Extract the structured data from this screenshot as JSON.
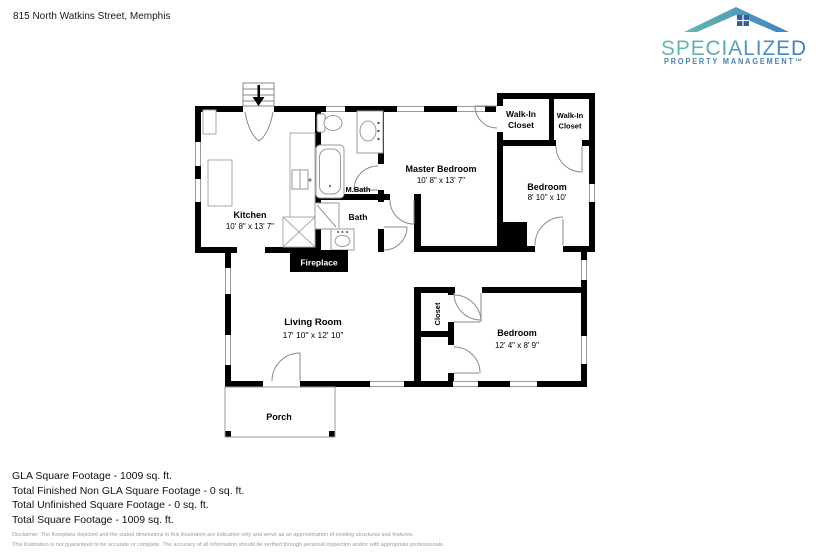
{
  "header": {
    "address": "815 North Watkins Street, Memphis"
  },
  "logo": {
    "brand": "SPECIALIZED",
    "tagline": "PROPERTY MANAGEMENT™",
    "gradient_start": "#63b7ac",
    "gradient_mid": "#4e97bd",
    "gradient_end": "#3e7ec4",
    "tagline_color": "#4c80ad",
    "roof_window_color": "#2d5f96"
  },
  "floorplan": {
    "wall_color": "#000000",
    "fixture_color": "#999999",
    "kitchen": {
      "name": "Kitchen",
      "dims": "10' 8\" x 13' 7\""
    },
    "master_bath": {
      "name": "M.Bath"
    },
    "bath": {
      "name": "Bath"
    },
    "fireplace": {
      "name": "Fireplace"
    },
    "master_bedroom": {
      "name": "Master Bedroom",
      "dims": "10' 8\" x 13' 7\""
    },
    "walk_in_closet_left": {
      "name_line1": "Walk-In",
      "name_line2": "Closet"
    },
    "walk_in_closet_right": {
      "name_line1": "Walk-In",
      "name_line2": "Closet"
    },
    "bedroom_upper": {
      "name": "Bedroom",
      "dims": "8' 10\" x 10'"
    },
    "living_room": {
      "name": "Living Room",
      "dims": "17' 10\" x 12' 10\""
    },
    "hall_closet": {
      "name": "Closet"
    },
    "bedroom_lower": {
      "name": "Bedroom",
      "dims": "12' 4\" x 8' 9\""
    },
    "porch": {
      "name": "Porch"
    }
  },
  "summary": {
    "lines": [
      "GLA Square Footage - 1009 sq. ft.",
      "Total Finished Non GLA Square Footage - 0 sq. ft.",
      "Total Unfinished Square Footage - 0 sq. ft.",
      "Total Square Footage - 1009 sq. ft."
    ]
  },
  "disclaimer": {
    "line1": "Disclaimer: The floorplans depicted and the stated dimensions in this illustration are indicative only and serve as an approximation of existing structures and features.",
    "line2": "This illustration is not guaranteed to be accurate or complete. The accuracy of all information should be verified through personal inspection and/or with appropriate professionals."
  }
}
